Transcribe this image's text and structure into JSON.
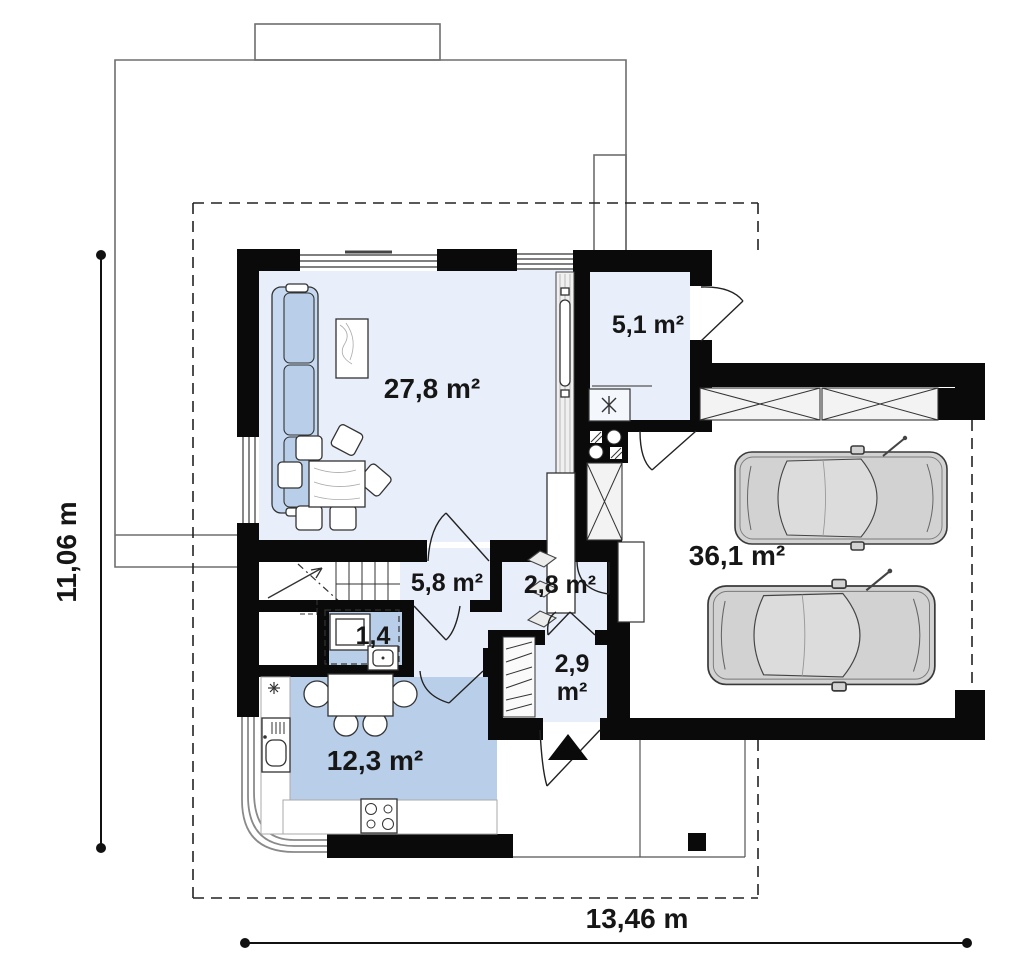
{
  "plan_title": "house-first-floor-plan",
  "rooms": {
    "living": {
      "label": "27,8 m²"
    },
    "pantry": {
      "label": "5,1 m²"
    },
    "hall": {
      "label": "5,8 m²"
    },
    "corridor": {
      "label": "2,8 m²"
    },
    "wc": {
      "label": "1,4"
    },
    "vestibule": {
      "label": "2,9",
      "label2": "m²"
    },
    "kitchen": {
      "label": "12,3 m²"
    },
    "garage": {
      "label": "36,1 m²"
    }
  },
  "dimensions": {
    "height": "11,06 m",
    "width": "13,46 m"
  },
  "colors": {
    "wall": "#0a0a0a",
    "room_light": "#e9effa",
    "room_medium": "#b9cfe9",
    "sofa": "#c6d9f0",
    "car_body": "#d2d2d2",
    "outline": "#6e6e6e"
  },
  "furniture": [
    "sofa",
    "coffee-table",
    "dining-table",
    "dining-chair",
    "tv-cabinet",
    "shelf",
    "plant",
    "boiler",
    "cooktop",
    "base-cabinet",
    "kitchen-counter",
    "kitchen-sink",
    "kitchen-table",
    "kitchen-chair",
    "stove",
    "wash-basin",
    "toilet",
    "wardrobe",
    "staircase",
    "car",
    "car",
    "entrance-arrow",
    "porch-pillar"
  ]
}
